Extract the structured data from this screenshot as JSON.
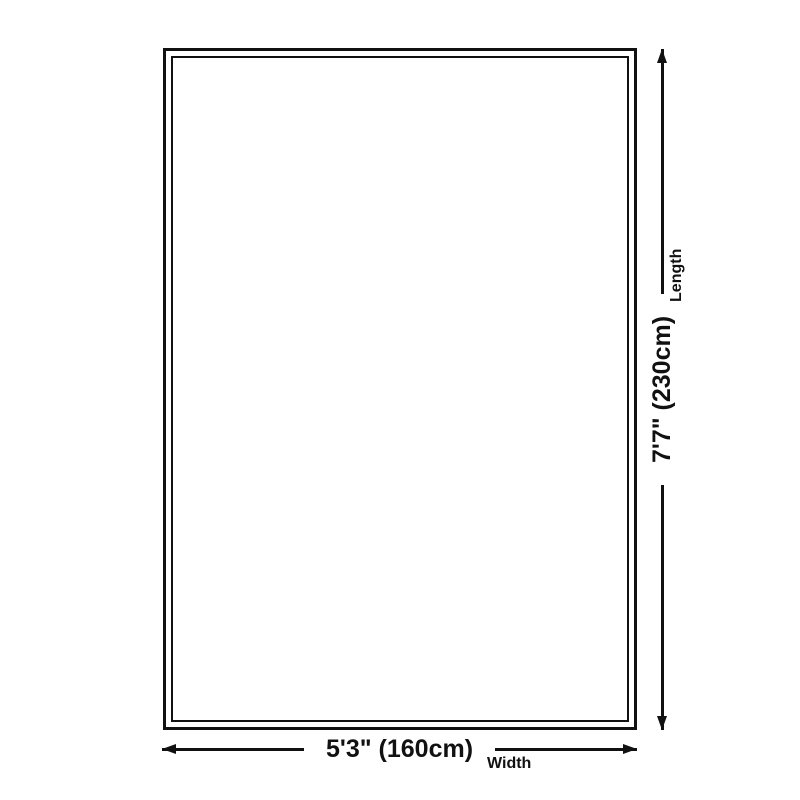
{
  "dimension_diagram": {
    "width": {
      "value": "5'3\" (160cm)",
      "label": "Width"
    },
    "length": {
      "value": "7'7\" (230cm)",
      "label": "Length"
    },
    "colors": {
      "line": "#111111",
      "background": "#ffffff"
    }
  }
}
